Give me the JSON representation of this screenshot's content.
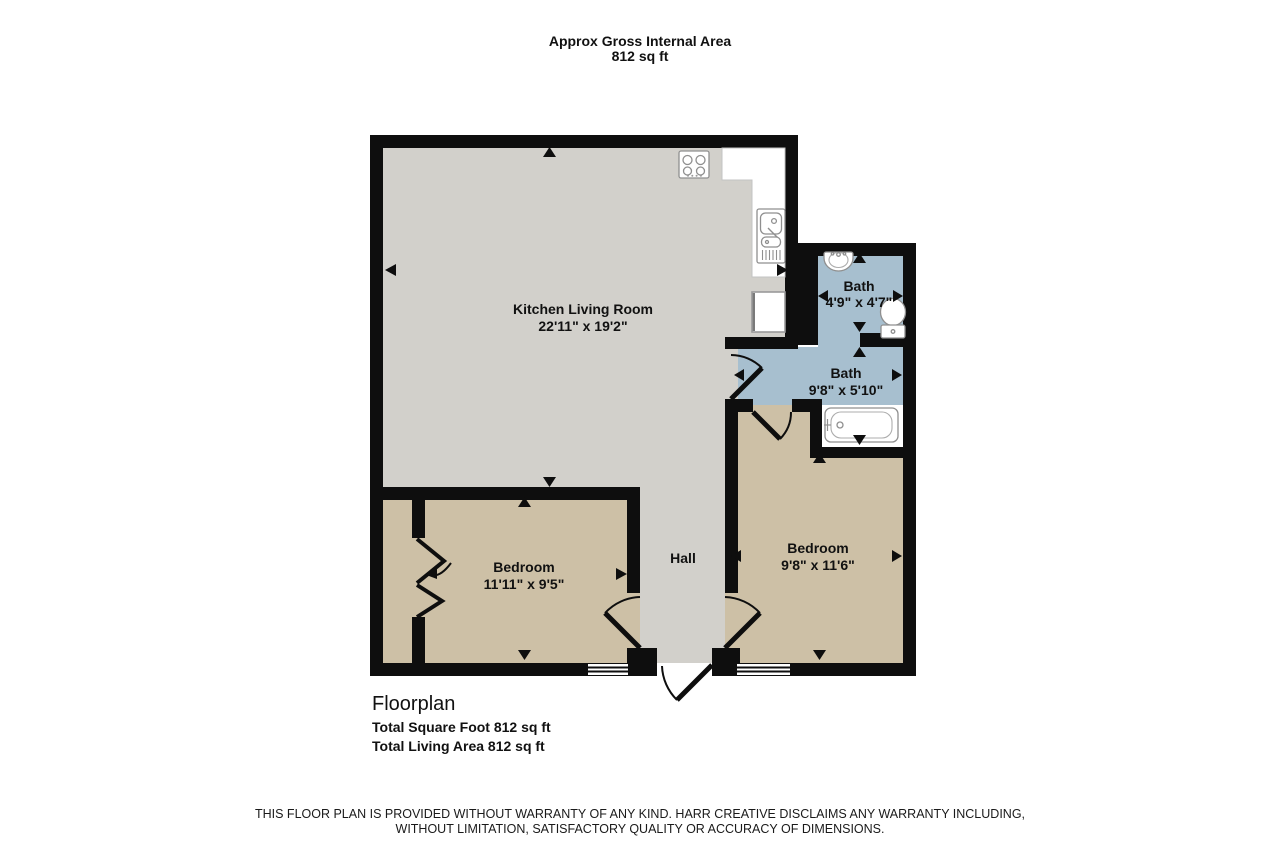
{
  "header": {
    "line1": "Approx Gross Internal Area",
    "line2": "812 sq ft"
  },
  "rooms": {
    "kitchen": {
      "name": "Kitchen Living Room",
      "dims": "22'11\" x 19'2\""
    },
    "bath_small": {
      "name": "Bath",
      "dims": "4'9\" x 4'7\""
    },
    "bath_large": {
      "name": "Bath",
      "dims": "9'8\" x 5'10\""
    },
    "bedroom_left": {
      "name": "Bedroom",
      "dims": "11'11\" x 9'5\""
    },
    "bedroom_right": {
      "name": "Bedroom",
      "dims": "9'8\" x 11'6\""
    },
    "hall": {
      "name": "Hall"
    }
  },
  "footer": {
    "title": "Floorplan",
    "total_sqft": "Total Square Foot 812 sq ft",
    "total_living": "Total Living Area 812 sq ft"
  },
  "disclaimer": {
    "line1": "THIS FLOOR PLAN IS PROVIDED WITHOUT WARRANTY OF ANY KIND. HARR CREATIVE DISCLAIMS ANY WARRANTY INCLUDING,",
    "line2": "WITHOUT LIMITATION, SATISFACTORY QUALITY OR ACCURACY OF DIMENSIONS."
  },
  "colors": {
    "wall": "#0e0e0e",
    "floor_gray": "#d2d0cb",
    "floor_tan": "#cdc0a6",
    "floor_blue": "#a7bfcf",
    "fixture_outline": "#8f8f8f"
  },
  "fixtures": [
    "stove",
    "kitchen-sink",
    "fridge",
    "bathroom-sink",
    "toilet",
    "bathtub"
  ]
}
